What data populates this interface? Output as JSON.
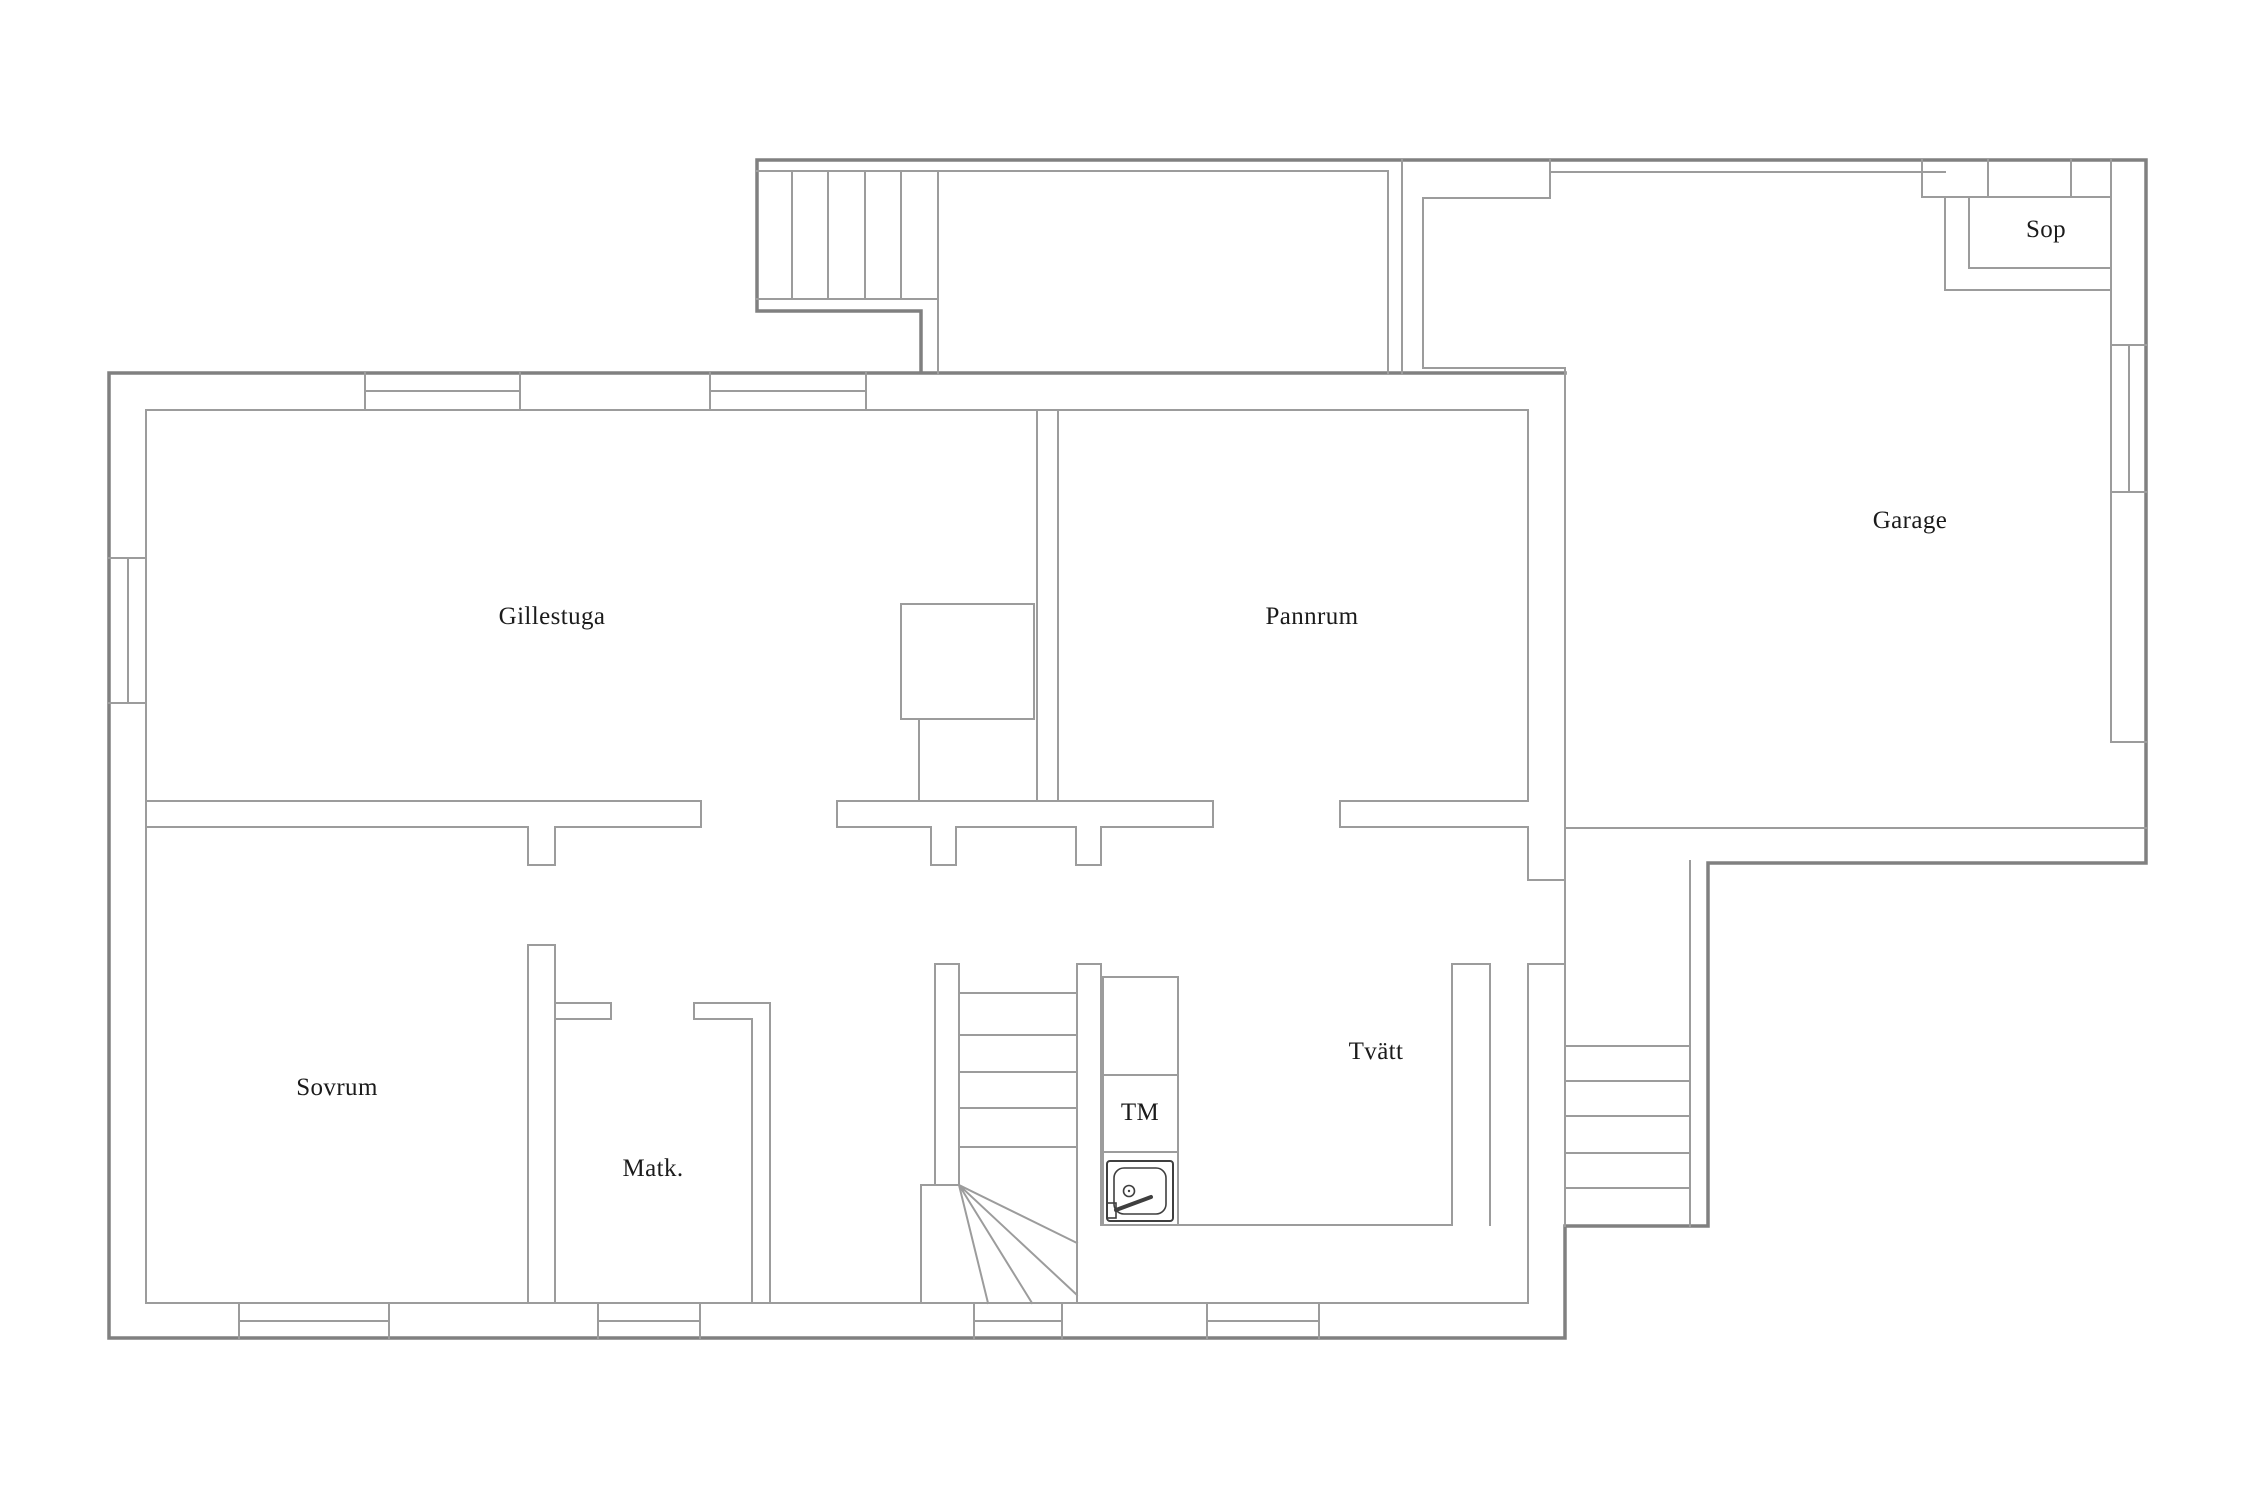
{
  "canvas": {
    "width": 2250,
    "height": 1500,
    "background": "#ffffff"
  },
  "colors": {
    "wall_thin": "#9c9c9c",
    "wall_thick": "#808080",
    "fixture": "#3f3f3f",
    "text": "#1b1b1b"
  },
  "rooms": [
    {
      "id": "gillestuga",
      "label": "Gillestuga"
    },
    {
      "id": "pannrum",
      "label": "Pannrum"
    },
    {
      "id": "garage",
      "label": "Garage"
    },
    {
      "id": "sop",
      "label": "Sop"
    },
    {
      "id": "sovrum",
      "label": "Sovrum"
    },
    {
      "id": "matk",
      "label": "Matk."
    },
    {
      "id": "tvatt",
      "label": "Tvätt"
    },
    {
      "id": "tm",
      "label": "TM"
    }
  ],
  "fixtures": [
    {
      "id": "sink",
      "icon": "sink-icon",
      "located_next_to": "TM"
    }
  ],
  "stairs": [
    {
      "id": "top-stairs",
      "treads": 5
    },
    {
      "id": "central-stairs",
      "treads": 5,
      "winder_lines": 4
    },
    {
      "id": "right-exterior-stairs",
      "treads": 5
    }
  ]
}
